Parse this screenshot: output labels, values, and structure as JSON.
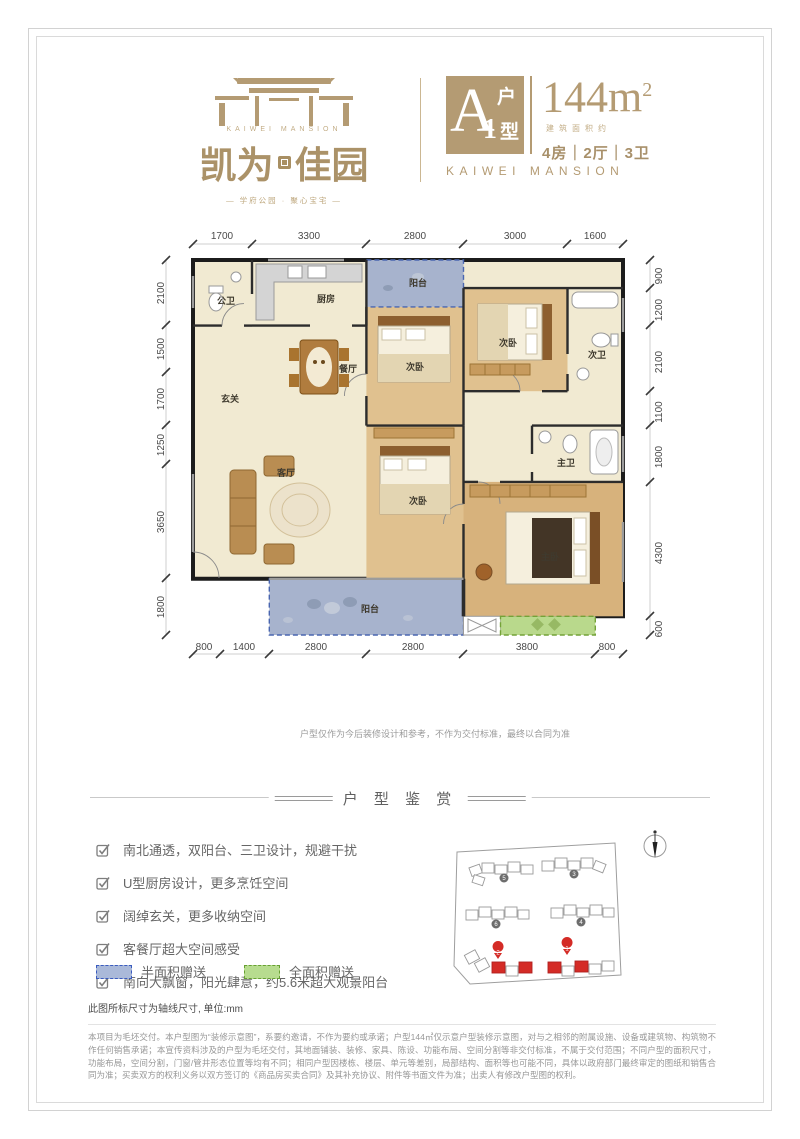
{
  "brand": {
    "logo_en": "KAIWEI MANSION",
    "logo_cn_left": "凯为",
    "logo_cn_right": "佳园",
    "tagline": "— 学府公园 · 聚心宝宅 —",
    "badge": {
      "letter": "A",
      "num": "1",
      "hu": "户",
      "xing": "型"
    },
    "area_value": "144",
    "area_unit_base": "m",
    "area_unit_sup": "2",
    "area_note": "建筑面积约",
    "rooms_spec": "4房｜2厅｜3卫",
    "brand_en": "KAIWEI MANSION",
    "accent_color": "#b49b73"
  },
  "floorplan": {
    "dims_top": [
      "1700",
      "3300",
      "2800",
      "3000",
      "1600"
    ],
    "dims_left": [
      "2100",
      "1500",
      "1700",
      "1250",
      "3650",
      "1800"
    ],
    "dims_right": [
      "900",
      "1200",
      "2100",
      "1100",
      "1800",
      "4300",
      "600"
    ],
    "dims_bottom": [
      "800",
      "1400",
      "2800",
      "2800",
      "3800",
      "800"
    ],
    "rooms": {
      "gongwei": "公卫",
      "kitchen": "厨房",
      "balcony_top": "阳台",
      "bed_a": "次卧",
      "bed_b": "次卧",
      "ciwei": "次卫",
      "foyer": "玄关",
      "dining": "餐厅",
      "living": "客厅",
      "bed_c": "次卧",
      "master": "主卧",
      "zhuwei": "主卫",
      "balcony_bottom": "阳台"
    },
    "half_gift_color": "#a7b3cd",
    "full_gift_color": "#b9d98c",
    "disclaimer": "户型仅作为今后装修设计和参考，不作为交付标准，最终以合同为准"
  },
  "appreciation": {
    "title": "户 型 鉴 赏",
    "features": [
      "南北通透，双阳台、三卫设计，规避干扰",
      "U型厨房设计，更多烹饪空间",
      "阔绰玄关，更多收纳空间",
      "客餐厅超大空间感受",
      "南向大飘窗，阳光肆意，约5.6米超大观景阳台"
    ],
    "legend": [
      {
        "label": "半面积赠送"
      },
      {
        "label": "全面积赠送"
      }
    ]
  },
  "siteplan": {
    "markers": [
      "5",
      "3",
      "6",
      "4",
      "2",
      "1"
    ],
    "highlight_color": "#d42b26"
  },
  "footer": {
    "axis_note": "此图所标尺寸为轴线尺寸, 单位:mm",
    "legal": "本项目为毛坯交付。本户型图为“装修示意图”，系要约邀请，不作为要约或承诺；户型144㎡仅示意户型装修示意图，对与之相邻的附属设施、设备或建筑物、构筑物不作任何销售承诺；本宣传资料涉及的户型为毛坯交付，其地面铺装、装修、家具、陈设、功能布局、空间分割等非交付标准，不属于交付范围；不同户型的面积尺寸，功能布局，空间分割，门窗/管井形态位置等均有不同；相同户型因楼栋、楼层、单元等差别，局部结构、面积等也可能不同，具体以政府部门最终审定的图纸和销售合同为准；买卖双方的权利义务以双方签订的《商品房买卖合同》及其补充协议、附件等书面文件为准；出卖人有修改户型图的权利。"
  }
}
